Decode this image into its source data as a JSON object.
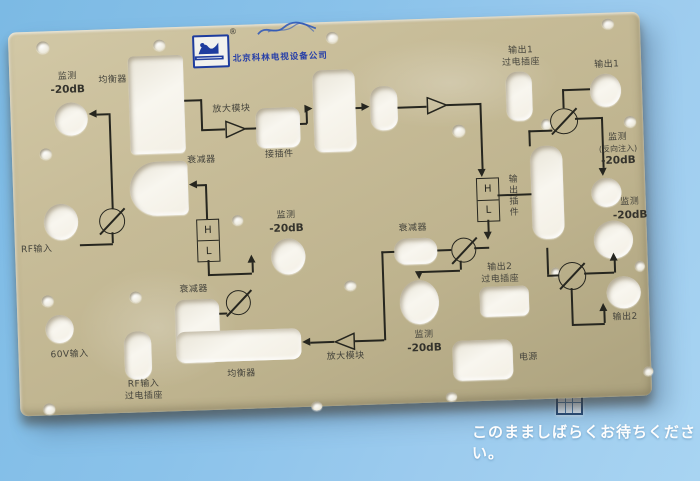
{
  "colors": {
    "background_top": "#7cbae4",
    "background_bottom": "#a8d4f2",
    "panel": "#c8bd99",
    "brand_blue": "#2840a8",
    "label_text": "#45443c",
    "line": "#26261f"
  },
  "overlay": {
    "wait_text": "このまましばらくお待ちください。",
    "grid_icon": "table-grid-icon"
  },
  "panel": {
    "company": {
      "name": "北京科林电视设备公司",
      "registered": "®",
      "logo_icon": "arch-bridge-logo"
    },
    "labels": {
      "monitor_tl_1": "监测",
      "monitor_tl_2": "-20dB",
      "equalizer_top": "均衡器",
      "amp_module_top": "放大模块",
      "connector_small": "接插件",
      "attenuator_top": "衰减器",
      "monitor_mid_1": "监测",
      "monitor_mid_2": "-20dB",
      "attenuator_left": "衰减器",
      "equalizer_bottom": "均衡器",
      "amp_module_bottom": "放大模块",
      "monitor_center_1": "监测",
      "monitor_center_2": "-20dB",
      "attenuator_mid": "衰减器",
      "output2_socket_1": "输出2",
      "output2_socket_2": "过电插座",
      "power": "电源",
      "output1_socket_1": "输出1",
      "output1_socket_2": "过电插座",
      "output1": "输出1",
      "monitor_rev_1": "监测",
      "monitor_rev_2": "(反向注入)",
      "monitor_rev_3": "-20dB",
      "monitor_right_1": "监测",
      "monitor_right_2": "-20dB",
      "output2": "输出2",
      "output_plugin": "输出插件",
      "rf_socket_1": "RF输入",
      "rf_socket_2": "过电插座",
      "v60_input": "60V输入",
      "rf_input": "RF输入",
      "h": "H",
      "l": "L"
    }
  }
}
